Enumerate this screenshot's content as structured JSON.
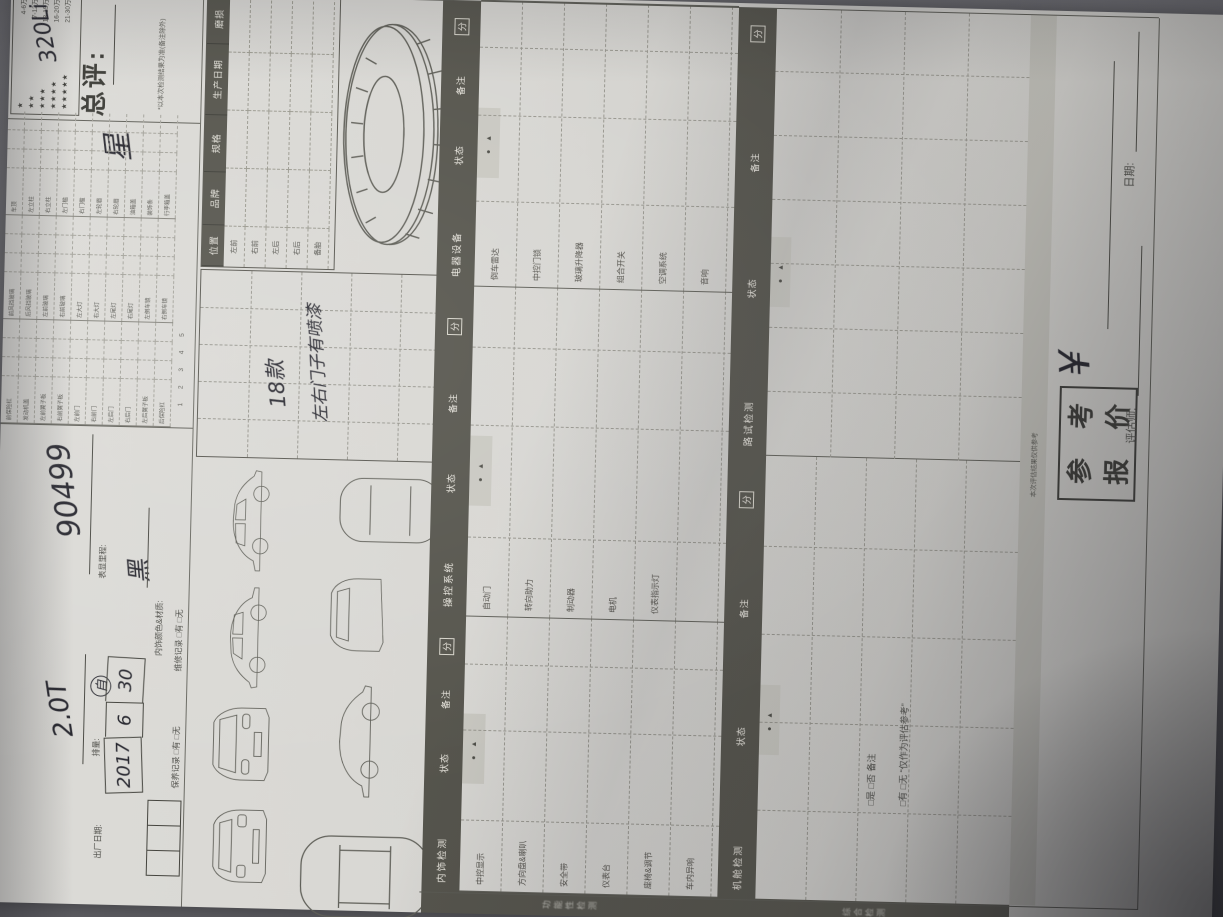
{
  "photo": {
    "surface_color": "#68686d",
    "paper_color": "#d7d6d2"
  },
  "legend": {
    "rows": [
      {
        "stars": "★",
        "range": "4-6万"
      },
      {
        "stars": "★★",
        "range": "7-12万"
      },
      {
        "stars": "★★★",
        "range": "13-15万"
      },
      {
        "stars": "★★★★",
        "range": "16-20万"
      },
      {
        "stars": "★★★★★",
        "range": "21-30万"
      }
    ]
  },
  "overall": {
    "label": "总评:",
    "value": "星",
    "note": "*以本次检测结果为准(备注除外)",
    "model": "320Li"
  },
  "fields": {
    "displacement_label": "排量:",
    "displacement": "2.0T",
    "gearbox": "自",
    "mileage_label": "表显里程:",
    "mileage": "90499",
    "interior_label": "内饰颜色&材质:",
    "interior": "黑",
    "date_label": "出厂日期:",
    "date": [
      "2017",
      "6",
      "30"
    ],
    "record1": "维修记录 □有 □无",
    "record2": "保养记录 □有 □无"
  },
  "defect": {
    "rows": [
      {
        "a": "前保险杠",
        "b": "前风挡玻璃",
        "c": "车顶"
      },
      {
        "a": "发动机盖",
        "b": "后风挡玻璃",
        "c": "左立柱"
      },
      {
        "a": "左前翼子板",
        "b": "左前玻璃",
        "c": "右立柱"
      },
      {
        "a": "右前翼子板",
        "b": "右前玻璃",
        "c": "左门槛"
      },
      {
        "a": "左前门",
        "b": "左大灯",
        "c": "右门槛"
      },
      {
        "a": "右前门",
        "b": "右大灯",
        "c": "左轮眉"
      },
      {
        "a": "左后门",
        "b": "左尾灯",
        "c": "右轮眉"
      },
      {
        "a": "右后门",
        "b": "右尾灯",
        "c": "油箱盖"
      },
      {
        "a": "左后翼子板",
        "b": "左倒车镜",
        "c": "装饰条"
      },
      {
        "a": "后保险杠",
        "b": "右倒车镜",
        "c": "行李箱盖"
      }
    ],
    "footer": "1        2        3        4        5"
  },
  "tire": {
    "headers": [
      "位置",
      "品牌",
      "规格",
      "生产日期",
      "磨损"
    ],
    "rows": [
      "左前",
      "右前",
      "左后",
      "右后",
      "备胎"
    ]
  },
  "notes": {
    "line1": "18款",
    "line2": "左右门子有喷漆"
  },
  "sec1": {
    "status": "状态",
    "symbols": "● ▲",
    "remark": "备注",
    "score": "分",
    "blocks": [
      {
        "name": "内饰检测",
        "items": [
          "中控显示",
          "方向盘&喇叭",
          "安全带",
          "仪表台",
          "座椅&调节",
          "车内异响"
        ]
      },
      {
        "name": "操控系统",
        "items": [
          "自动门",
          "转向助力",
          "制动器",
          "电机",
          "仪表指示灯",
          ""
        ]
      },
      {
        "name": "电器设备",
        "items": [
          "倒车雷达",
          "中控门锁",
          "玻璃升降器",
          "组合开关",
          "空调系统",
          "音响"
        ]
      }
    ]
  },
  "sec2": {
    "status": "状态",
    "symbols": "● ▲",
    "remark": "备注",
    "score": "分",
    "blocks": [
      {
        "name": "机舱检测"
      },
      {
        "name": "路试检测"
      }
    ]
  },
  "sidebar": {
    "top": "功能性检测",
    "bottom": "综合检测"
  },
  "band_note": "本次评估结果仅供参考",
  "checks": {
    "line1": "□是  □否  备注",
    "line2": "□有  □无  “仅作为评估参考”"
  },
  "price": {
    "stamp": [
      "参",
      "考",
      "报",
      "价"
    ],
    "currency": "¥"
  },
  "footer": {
    "assessor": "评估师:",
    "date": "日期:"
  }
}
